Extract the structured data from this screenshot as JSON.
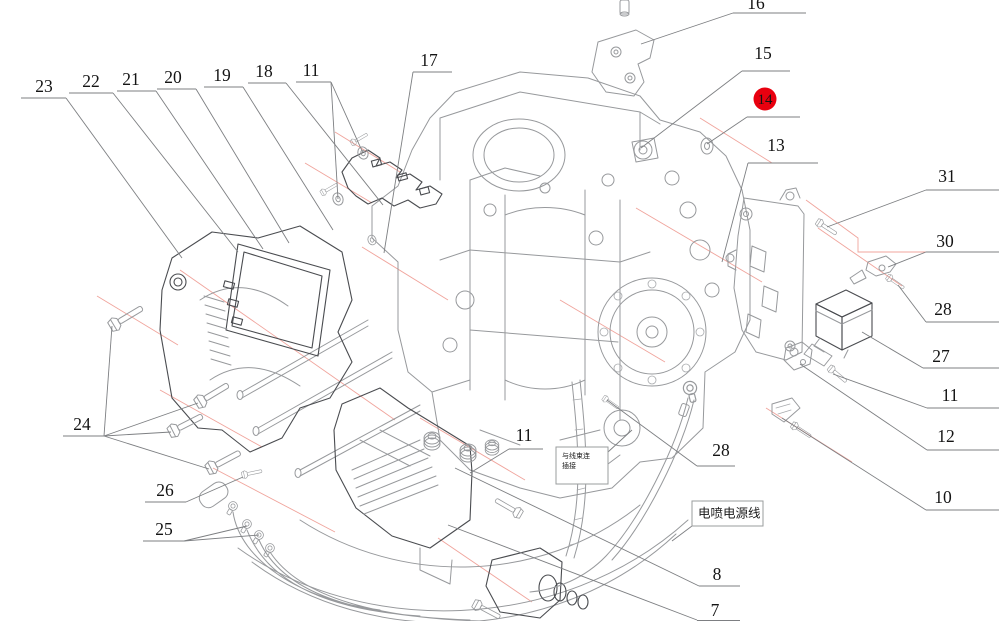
{
  "diagram": {
    "type": "exploded-parts-diagram",
    "subject": "engine EFI wiring and bracket assembly exploded view",
    "colors": {
      "background": "#ffffff",
      "part_line_light": "#97999c",
      "part_line_dark": "#4a4c50",
      "centerline_pink": "#f0a49c",
      "callout_line": "#7d7f82",
      "callout_text": "#141414",
      "highlight_circle": "#e8000f"
    },
    "callouts": [
      {
        "id": "c23",
        "label": "23",
        "x": 44,
        "y": 92,
        "underline": [
          21,
          66,
          98
        ],
        "leaders": [
          [
            [
              66,
              98
            ],
            [
              182,
              258
            ]
          ]
        ]
      },
      {
        "id": "c22",
        "label": "22",
        "x": 91,
        "y": 87,
        "underline": [
          69,
          113,
          93
        ],
        "leaders": [
          [
            [
              113,
              93
            ],
            [
              238,
              252
            ]
          ]
        ]
      },
      {
        "id": "c21",
        "label": "21",
        "x": 131,
        "y": 85,
        "underline": [
          117,
          156,
          91
        ],
        "leaders": [
          [
            [
              156,
              91
            ],
            [
              263,
              249
            ]
          ]
        ]
      },
      {
        "id": "c20",
        "label": "20",
        "x": 173,
        "y": 83,
        "underline": [
          157,
          196,
          89
        ],
        "leaders": [
          [
            [
              196,
              89
            ],
            [
              289,
              243
            ]
          ]
        ]
      },
      {
        "id": "c19",
        "label": "19",
        "x": 222,
        "y": 81,
        "underline": [
          204,
          243,
          87
        ],
        "leaders": [
          [
            [
              243,
              87
            ],
            [
              333,
              230
            ]
          ]
        ]
      },
      {
        "id": "c18",
        "label": "18",
        "x": 264,
        "y": 77,
        "underline": [
          248,
          286,
          83
        ],
        "leaders": [
          [
            [
              286,
              83
            ],
            [
              383,
              205
            ]
          ]
        ]
      },
      {
        "id": "c11a",
        "label": "11",
        "x": 311,
        "y": 76,
        "underline": [
          296,
          331,
          82
        ],
        "leaders": [
          [
            [
              331,
              82
            ],
            [
              363,
              153
            ]
          ],
          [
            [
              331,
              82
            ],
            [
              338,
              199
            ]
          ]
        ]
      },
      {
        "id": "c17",
        "label": "17",
        "x": 429,
        "y": 66,
        "underline": [
          413,
          452,
          72
        ],
        "leaders": [
          [
            [
              413,
              72
            ],
            [
              384,
              253
            ]
          ]
        ]
      },
      {
        "id": "c16",
        "label": "16",
        "x": 756,
        "y": 9,
        "underline": [
          733,
          806,
          13
        ],
        "leaders": [
          [
            [
              733,
              13
            ],
            [
              641,
              44
            ]
          ]
        ]
      },
      {
        "id": "c15",
        "label": "15",
        "x": 763,
        "y": 59,
        "underline": [
          742,
          790,
          71
        ],
        "leaders": [
          [
            [
              742,
              71
            ],
            [
              641,
              148
            ]
          ]
        ]
      },
      {
        "id": "c14",
        "label": "14",
        "x": 765,
        "y": 104,
        "cx": 765,
        "cy": 99,
        "highlight": true,
        "underline": [
          747,
          800,
          117
        ],
        "leaders": [
          [
            [
              747,
              117
            ],
            [
              707,
              144
            ]
          ]
        ]
      },
      {
        "id": "c13",
        "label": "13",
        "x": 776,
        "y": 151,
        "underline": [
          748,
          818,
          163
        ],
        "leaders": [
          [
            [
              748,
              163
            ],
            [
              722,
              262
            ]
          ]
        ]
      },
      {
        "id": "c31",
        "label": "31",
        "x": 947,
        "y": 182,
        "underline": [
          926,
          999,
          190
        ],
        "leaders": [
          [
            [
              926,
              190
            ],
            [
              827,
              227
            ]
          ]
        ]
      },
      {
        "id": "c30",
        "label": "30",
        "x": 945,
        "y": 247,
        "underline": [
          926,
          999,
          252
        ],
        "leaders": [
          [
            [
              926,
              252
            ],
            [
              888,
              267
            ]
          ]
        ]
      },
      {
        "id": "c28r",
        "label": "28",
        "x": 943,
        "y": 315,
        "underline": [
          926,
          999,
          322
        ],
        "leaders": [
          [
            [
              926,
              322
            ],
            [
              898,
              285
            ]
          ]
        ]
      },
      {
        "id": "c27",
        "label": "27",
        "x": 941,
        "y": 362,
        "underline": [
          923,
          999,
          368
        ],
        "leaders": [
          [
            [
              923,
              368
            ],
            [
              862,
              332
            ]
          ]
        ]
      },
      {
        "id": "c11r",
        "label": "11",
        "x": 950,
        "y": 401,
        "underline": [
          927,
          999,
          408
        ],
        "leaders": [
          [
            [
              927,
              408
            ],
            [
              833,
              374
            ]
          ]
        ]
      },
      {
        "id": "c12",
        "label": "12",
        "x": 946,
        "y": 442,
        "underline": [
          927,
          999,
          450
        ],
        "leaders": [
          [
            [
              927,
              450
            ],
            [
              800,
              364
            ]
          ]
        ]
      },
      {
        "id": "c10",
        "label": "10",
        "x": 943,
        "y": 503,
        "underline": [
          926,
          999,
          510
        ],
        "leaders": [
          [
            [
              926,
              510
            ],
            [
              782,
              418
            ]
          ]
        ]
      },
      {
        "id": "c8",
        "label": "8",
        "x": 717,
        "y": 580,
        "underline": [
          699,
          740,
          586
        ],
        "leaders": [
          [
            [
              699,
              586
            ],
            [
              455,
              468
            ]
          ]
        ]
      },
      {
        "id": "c7",
        "label": "7",
        "x": 715,
        "y": 616,
        "underline": [
          697,
          740,
          620.5
        ],
        "leaders": [
          [
            [
              697,
              620
            ],
            [
              448,
              525
            ]
          ]
        ]
      },
      {
        "id": "c11c",
        "label": "11",
        "x": 524,
        "y": 441,
        "underline": [
          509,
          543,
          449
        ],
        "leaders": [
          [
            [
              509,
              449
            ],
            [
              470,
              473
            ]
          ]
        ]
      },
      {
        "id": "c28c",
        "label": "28",
        "x": 721,
        "y": 456,
        "underline": [
          697,
          735,
          466
        ],
        "leaders": [
          [
            [
              697,
              466
            ],
            [
              607,
              400
            ]
          ]
        ]
      },
      {
        "id": "c24",
        "label": "24",
        "x": 82,
        "y": 430,
        "underline": [
          63,
          104,
          436
        ],
        "leaders": [
          [
            [
              104,
              436
            ],
            [
              112,
              326
            ]
          ],
          [
            [
              104,
              436
            ],
            [
              198,
              403
            ]
          ],
          [
            [
              104,
              436
            ],
            [
              171,
              432
            ]
          ],
          [
            [
              104,
              436
            ],
            [
              209,
              469
            ]
          ]
        ]
      },
      {
        "id": "c26",
        "label": "26",
        "x": 165,
        "y": 496,
        "underline": [
          145,
          186,
          502
        ],
        "leaders": [
          [
            [
              186,
              502
            ],
            [
              243,
              477
            ]
          ]
        ]
      },
      {
        "id": "c25",
        "label": "25",
        "x": 164,
        "y": 535,
        "underline": [
          143,
          184,
          541
        ],
        "leaders": [
          [
            [
              184,
              541
            ],
            [
              247,
              526
            ]
          ],
          [
            [
              184,
              541
            ],
            [
              259,
              535
            ]
          ]
        ]
      }
    ],
    "notes": [
      {
        "id": "note-harness-connect",
        "lines": [
          "与线束连",
          "插接"
        ],
        "box": [
          556,
          447,
          52,
          37
        ],
        "font": 7,
        "leader": [
          [
            608,
            452
          ],
          [
            632,
            430
          ]
        ]
      },
      {
        "id": "note-efi-power",
        "lines": [
          "电喷电源线"
        ],
        "box": [
          692,
          501,
          71,
          25
        ],
        "font": 12.5,
        "leader": [
          [
            692,
            526
          ],
          [
            672,
            541
          ]
        ]
      }
    ]
  }
}
